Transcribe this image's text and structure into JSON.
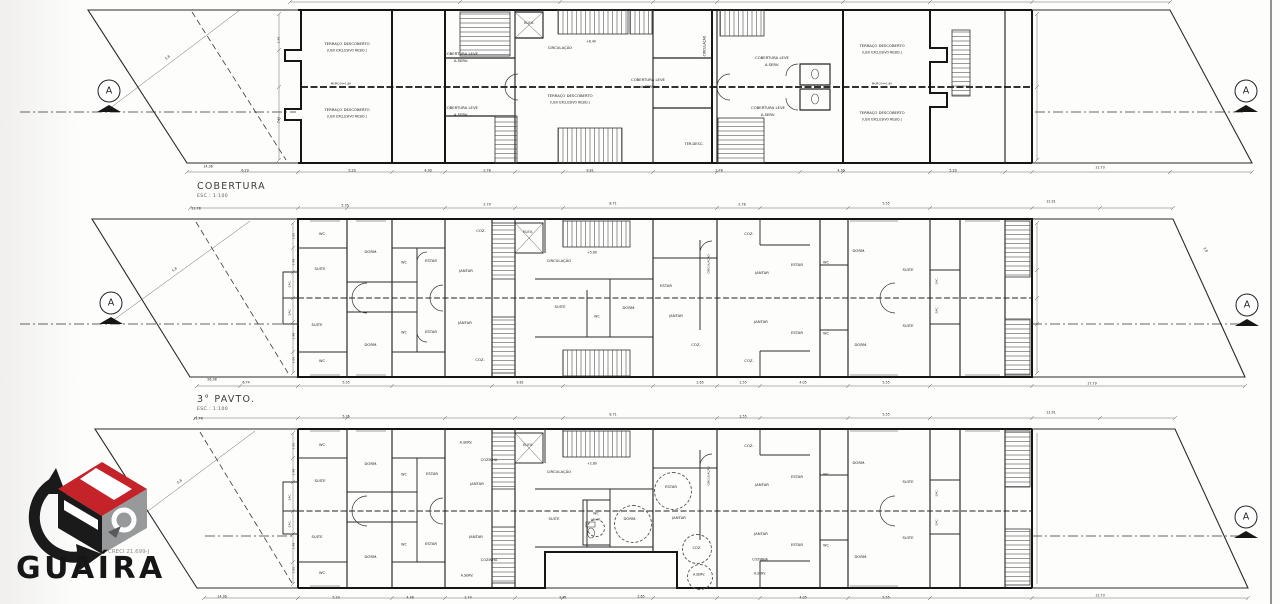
{
  "document": {
    "type": "architectural floor plans",
    "sheet_border_color": "#4a4a4a"
  },
  "section_marker_letter": "A",
  "logo": {
    "name": "GUAÍRA",
    "creci": "CRECI 21.699-J",
    "colors": {
      "red": "#c4232a",
      "gray": "#97999b",
      "black": "#1a1a1a"
    }
  },
  "plans": [
    {
      "title": "COBERTURA",
      "scale_note": "ESC.: 1:100",
      "texts": [
        {
          "t": "TERRAÇO DESCOBERTO",
          "x": 347,
          "y": 44
        },
        {
          "t": "(USO EXCLUSIVO RESID.)",
          "x": 347,
          "y": 51,
          "fs": 3.2
        },
        {
          "t": "TERRAÇO DESCOBERTO",
          "x": 347,
          "y": 110
        },
        {
          "t": "(USO EXCLUSIVO RESID.)",
          "x": 347,
          "y": 117,
          "fs": 3.2
        },
        {
          "t": "COBERTURA LEVE",
          "x": 461,
          "y": 54
        },
        {
          "t": "A.SERV.",
          "x": 461,
          "y": 61
        },
        {
          "t": "COBERTURA LEVE",
          "x": 461,
          "y": 108
        },
        {
          "t": "A.SERV.",
          "x": 461,
          "y": 115
        },
        {
          "t": "ELEV.",
          "x": 529,
          "y": 24,
          "fs": 3.6
        },
        {
          "t": "CIRCULAÇÃO",
          "x": 560,
          "y": 48
        },
        {
          "t": "+8.40",
          "x": 591,
          "y": 42,
          "fs": 3.2
        },
        {
          "t": "TERRAÇO DESCOBERTO",
          "x": 570,
          "y": 96
        },
        {
          "t": "(USO EXCLUSIVO RESID.)",
          "x": 570,
          "y": 103,
          "fs": 3.2
        },
        {
          "t": "COBERTURA LEVE",
          "x": 648,
          "y": 80
        },
        {
          "t": "A.SERV.",
          "x": 648,
          "y": 87
        },
        {
          "t": "TER.DESC.",
          "x": 694,
          "y": 145,
          "fs": 3.6
        },
        {
          "t": "CIRCULAÇÃO",
          "x": 705,
          "y": 46,
          "fs": 3.2,
          "r": -90
        },
        {
          "t": "COBERTURA LEVE",
          "x": 772,
          "y": 58
        },
        {
          "t": "A.SERV.",
          "x": 772,
          "y": 65
        },
        {
          "t": "COBERTURA LEVE",
          "x": 768,
          "y": 108
        },
        {
          "t": "A.SERV.",
          "x": 768,
          "y": 115
        },
        {
          "t": "TERRAÇO DESCOBERTO",
          "x": 882,
          "y": 46
        },
        {
          "t": "(USO EXCLUSIVO RESID.)",
          "x": 882,
          "y": 53,
          "fs": 3.2
        },
        {
          "t": "TERRAÇO DESCOBERTO",
          "x": 882,
          "y": 113
        },
        {
          "t": "(USO EXCLUSIVO RESID.)",
          "x": 882,
          "y": 120,
          "fs": 3.2
        },
        {
          "t": "MURO H=1.80",
          "x": 341,
          "y": 84,
          "fs": 2.8
        },
        {
          "t": "MURO H=1.80",
          "x": 882,
          "y": 84,
          "fs": 2.8
        },
        {
          "t": "14.36",
          "x": 208,
          "y": 167,
          "fs": 3.3
        },
        {
          "t": "6.29",
          "x": 245,
          "y": 171,
          "fs": 3.3
        },
        {
          "t": "5.20",
          "x": 352,
          "y": 171,
          "fs": 3.3
        },
        {
          "t": "4.30",
          "x": 428,
          "y": 171,
          "fs": 3.3
        },
        {
          "t": "2.78",
          "x": 487,
          "y": 171,
          "fs": 3.3
        },
        {
          "t": "9.81",
          "x": 590,
          "y": 171,
          "fs": 3.3
        },
        {
          "t": "2.78",
          "x": 719,
          "y": 171,
          "fs": 3.3
        },
        {
          "t": "4.30",
          "x": 841,
          "y": 171,
          "fs": 3.3
        },
        {
          "t": "5.20",
          "x": 953,
          "y": 171,
          "fs": 3.3
        },
        {
          "t": "11.73",
          "x": 1100,
          "y": 168,
          "fs": 3.3
        },
        {
          "t": "5.8",
          "x": 168,
          "y": 58,
          "fs": 3.3,
          "r": -37
        },
        {
          "t": "2.40",
          "x": 279,
          "y": 40,
          "fs": 3,
          "r": -90
        },
        {
          "t": "1.48",
          "x": 279,
          "y": 120,
          "fs": 3,
          "r": -90
        }
      ],
      "circles": []
    },
    {
      "title": "3° PAVTO.",
      "scale_note": "ESC.: 1:100",
      "texts": [
        {
          "t": "WC",
          "x": 322,
          "y": 235,
          "fs": 3.6
        },
        {
          "t": "SUITE",
          "x": 320,
          "y": 269
        },
        {
          "t": "DORM.",
          "x": 371,
          "y": 252
        },
        {
          "t": "WC",
          "x": 404,
          "y": 263,
          "fs": 3.4
        },
        {
          "t": "ESTAR",
          "x": 431,
          "y": 261
        },
        {
          "t": "JANTAR",
          "x": 466,
          "y": 271
        },
        {
          "t": "COZ.",
          "x": 481,
          "y": 231
        },
        {
          "t": "SAC.",
          "x": 290,
          "y": 284,
          "fs": 3,
          "r": -90
        },
        {
          "t": "SAC.",
          "x": 290,
          "y": 312,
          "fs": 3,
          "r": -90
        },
        {
          "t": "SUITE",
          "x": 317,
          "y": 325
        },
        {
          "t": "DORM.",
          "x": 371,
          "y": 345
        },
        {
          "t": "WC",
          "x": 322,
          "y": 362,
          "fs": 3.6
        },
        {
          "t": "WC",
          "x": 404,
          "y": 333,
          "fs": 3.4
        },
        {
          "t": "ESTAR",
          "x": 431,
          "y": 332
        },
        {
          "t": "JANTAR",
          "x": 465,
          "y": 323
        },
        {
          "t": "COZ.",
          "x": 480,
          "y": 360
        },
        {
          "t": "ELEV.",
          "x": 528,
          "y": 233,
          "fs": 3.6
        },
        {
          "t": "CIRCULAÇÃO",
          "x": 559,
          "y": 261
        },
        {
          "t": "+5.60",
          "x": 592,
          "y": 253,
          "fs": 3.2
        },
        {
          "t": "SUITE",
          "x": 560,
          "y": 307
        },
        {
          "t": "WC",
          "x": 597,
          "y": 317,
          "fs": 3.2
        },
        {
          "t": "DORM.",
          "x": 629,
          "y": 308
        },
        {
          "t": "ESTAR",
          "x": 666,
          "y": 286
        },
        {
          "t": "JANTAR",
          "x": 676,
          "y": 316
        },
        {
          "t": "COZ.",
          "x": 696,
          "y": 345
        },
        {
          "t": "CIRCULAÇÃO",
          "x": 709,
          "y": 264,
          "fs": 3,
          "r": -90
        },
        {
          "t": "COZ.",
          "x": 749,
          "y": 234
        },
        {
          "t": "JANTAR",
          "x": 762,
          "y": 273
        },
        {
          "t": "ESTAR",
          "x": 797,
          "y": 265
        },
        {
          "t": "WC",
          "x": 826,
          "y": 263,
          "fs": 3.4
        },
        {
          "t": "DORM.",
          "x": 859,
          "y": 251
        },
        {
          "t": "SUITE",
          "x": 908,
          "y": 270
        },
        {
          "t": "SAC.",
          "x": 937,
          "y": 281,
          "fs": 3,
          "r": -90
        },
        {
          "t": "SAC.",
          "x": 937,
          "y": 310,
          "fs": 3,
          "r": -90
        },
        {
          "t": "JANTAR",
          "x": 761,
          "y": 322
        },
        {
          "t": "ESTAR",
          "x": 797,
          "y": 333
        },
        {
          "t": "WC",
          "x": 826,
          "y": 334,
          "fs": 3.4
        },
        {
          "t": "DORM.",
          "x": 861,
          "y": 345
        },
        {
          "t": "SUITE",
          "x": 908,
          "y": 326
        },
        {
          "t": "COZ.",
          "x": 749,
          "y": 361
        },
        {
          "t": "11.78",
          "x": 196,
          "y": 209,
          "fs": 3.3
        },
        {
          "t": "5.35",
          "x": 345,
          "y": 206,
          "fs": 3.3
        },
        {
          "t": "2.79",
          "x": 487,
          "y": 205,
          "fs": 3.3
        },
        {
          "t": "8.71",
          "x": 613,
          "y": 204,
          "fs": 3.3
        },
        {
          "t": "2.78",
          "x": 742,
          "y": 205,
          "fs": 3.3
        },
        {
          "t": "5.55",
          "x": 886,
          "y": 204,
          "fs": 3.3
        },
        {
          "t": "12.91",
          "x": 1051,
          "y": 202,
          "fs": 3.3
        },
        {
          "t": "56.38",
          "x": 212,
          "y": 380,
          "fs": 3.3
        },
        {
          "t": "6.74",
          "x": 246,
          "y": 383,
          "fs": 3.3
        },
        {
          "t": "5.35",
          "x": 346,
          "y": 383,
          "fs": 3.3
        },
        {
          "t": "9.81",
          "x": 520,
          "y": 383,
          "fs": 3.3
        },
        {
          "t": "2.65",
          "x": 700,
          "y": 383,
          "fs": 3.3
        },
        {
          "t": "2.55",
          "x": 743,
          "y": 383,
          "fs": 3.3
        },
        {
          "t": "4.05",
          "x": 803,
          "y": 383,
          "fs": 3.3
        },
        {
          "t": "5.55",
          "x": 886,
          "y": 383,
          "fs": 3.3
        },
        {
          "t": "17.79",
          "x": 1092,
          "y": 384,
          "fs": 3.3
        },
        {
          "t": "5.8",
          "x": 175,
          "y": 270,
          "fs": 3.3,
          "r": -37
        },
        {
          "t": "3.8",
          "x": 1205,
          "y": 250,
          "fs": 3.3,
          "r": 60
        },
        {
          "t": "1.05",
          "x": 294,
          "y": 236,
          "fs": 3,
          "r": -90
        },
        {
          "t": "1.48",
          "x": 294,
          "y": 262,
          "fs": 3,
          "r": -90
        },
        {
          "t": "1.48",
          "x": 294,
          "y": 336,
          "fs": 3,
          "r": -90
        },
        {
          "t": "1.05",
          "x": 294,
          "y": 360,
          "fs": 3,
          "r": -90
        }
      ],
      "circles": []
    },
    {
      "title": "",
      "scale_note": "",
      "texts": [
        {
          "t": "WC",
          "x": 322,
          "y": 446,
          "fs": 3.6
        },
        {
          "t": "SUITE",
          "x": 320,
          "y": 481
        },
        {
          "t": "DORM.",
          "x": 371,
          "y": 464
        },
        {
          "t": "WC",
          "x": 404,
          "y": 475,
          "fs": 3.4
        },
        {
          "t": "ESTAR",
          "x": 432,
          "y": 474
        },
        {
          "t": "A.SERV.",
          "x": 466,
          "y": 443,
          "fs": 3.4
        },
        {
          "t": "COZINHA",
          "x": 489,
          "y": 461,
          "fs": 3.6
        },
        {
          "t": "JANTAR",
          "x": 477,
          "y": 484
        },
        {
          "t": "SAC.",
          "x": 290,
          "y": 497,
          "fs": 3,
          "r": -90
        },
        {
          "t": "SAC.",
          "x": 290,
          "y": 524,
          "fs": 3,
          "r": -90
        },
        {
          "t": "SUITE",
          "x": 317,
          "y": 537
        },
        {
          "t": "DORM.",
          "x": 371,
          "y": 557
        },
        {
          "t": "WC",
          "x": 322,
          "y": 574,
          "fs": 3.6
        },
        {
          "t": "WC",
          "x": 404,
          "y": 545,
          "fs": 3.4
        },
        {
          "t": "ESTAR",
          "x": 431,
          "y": 544
        },
        {
          "t": "JANTAR",
          "x": 476,
          "y": 537
        },
        {
          "t": "COZINHA",
          "x": 489,
          "y": 561,
          "fs": 3.6
        },
        {
          "t": "A.SERV.",
          "x": 467,
          "y": 576,
          "fs": 3.4
        },
        {
          "t": "ELEV.",
          "x": 528,
          "y": 446,
          "fs": 3.6
        },
        {
          "t": "CIRCULAÇÃO",
          "x": 559,
          "y": 472
        },
        {
          "t": "+2.80",
          "x": 592,
          "y": 464,
          "fs": 3.2
        },
        {
          "t": "SUITE",
          "x": 554,
          "y": 519
        },
        {
          "t": "WC",
          "x": 596,
          "y": 514,
          "fs": 3.2
        },
        {
          "t": "ADAPT.",
          "x": 596,
          "y": 520,
          "fs": 2.8
        },
        {
          "t": "DORM.",
          "x": 630,
          "y": 519
        },
        {
          "t": "ESTAR",
          "x": 671,
          "y": 487
        },
        {
          "t": "JANTAR",
          "x": 679,
          "y": 518
        },
        {
          "t": "COZ.",
          "x": 697,
          "y": 549,
          "fs": 3.6
        },
        {
          "t": "A.SERV.",
          "x": 699,
          "y": 575,
          "fs": 3.2
        },
        {
          "t": "CIRCULAÇÃO",
          "x": 709,
          "y": 476,
          "fs": 3,
          "r": -90
        },
        {
          "t": "COZ.",
          "x": 749,
          "y": 446
        },
        {
          "t": "JANTAR",
          "x": 762,
          "y": 485
        },
        {
          "t": "ESTAR",
          "x": 797,
          "y": 477
        },
        {
          "t": "WC",
          "x": 826,
          "y": 475,
          "fs": 3.4
        },
        {
          "t": "DORM.",
          "x": 859,
          "y": 463
        },
        {
          "t": "SUITE",
          "x": 908,
          "y": 482
        },
        {
          "t": "SAC.",
          "x": 937,
          "y": 493,
          "fs": 3,
          "r": -90
        },
        {
          "t": "SAC.",
          "x": 937,
          "y": 522,
          "fs": 3,
          "r": -90
        },
        {
          "t": "JANTAR",
          "x": 761,
          "y": 534
        },
        {
          "t": "ESTAR",
          "x": 797,
          "y": 545
        },
        {
          "t": "WC",
          "x": 826,
          "y": 546,
          "fs": 3.4
        },
        {
          "t": "DORM.",
          "x": 861,
          "y": 557
        },
        {
          "t": "SUITE",
          "x": 908,
          "y": 538
        },
        {
          "t": "COZINHA",
          "x": 760,
          "y": 560,
          "fs": 3.4
        },
        {
          "t": "A.SERV.",
          "x": 760,
          "y": 574,
          "fs": 3.2
        },
        {
          "t": "11.78",
          "x": 198,
          "y": 419,
          "fs": 3.3
        },
        {
          "t": "5.35",
          "x": 346,
          "y": 417,
          "fs": 3.3
        },
        {
          "t": "8.71",
          "x": 613,
          "y": 415,
          "fs": 3.3
        },
        {
          "t": "2.55",
          "x": 743,
          "y": 417,
          "fs": 3.3
        },
        {
          "t": "5.55",
          "x": 886,
          "y": 415,
          "fs": 3.3
        },
        {
          "t": "12.91",
          "x": 1051,
          "y": 413,
          "fs": 3.3
        },
        {
          "t": "14.36",
          "x": 222,
          "y": 597,
          "fs": 3.3
        },
        {
          "t": "5.20",
          "x": 336,
          "y": 598,
          "fs": 3.3
        },
        {
          "t": "4.38",
          "x": 410,
          "y": 598,
          "fs": 3.3
        },
        {
          "t": "2.74",
          "x": 468,
          "y": 598,
          "fs": 3.3
        },
        {
          "t": "9.81",
          "x": 563,
          "y": 598,
          "fs": 3.3
        },
        {
          "t": "2.65",
          "x": 641,
          "y": 597,
          "fs": 3.3
        },
        {
          "t": "4.05",
          "x": 803,
          "y": 598,
          "fs": 3.3
        },
        {
          "t": "5.55",
          "x": 886,
          "y": 598,
          "fs": 3.3
        },
        {
          "t": "11.73",
          "x": 1100,
          "y": 596,
          "fs": 3.3
        },
        {
          "t": "5.8",
          "x": 180,
          "y": 482,
          "fs": 3.3,
          "r": -37
        },
        {
          "t": "1.05",
          "x": 294,
          "y": 446,
          "fs": 3,
          "r": -90
        },
        {
          "t": "1.48",
          "x": 294,
          "y": 472,
          "fs": 3,
          "r": -90
        },
        {
          "t": "1.48",
          "x": 294,
          "y": 546,
          "fs": 3,
          "r": -90
        },
        {
          "t": "1.05",
          "x": 294,
          "y": 570,
          "fs": 3,
          "r": -90
        }
      ],
      "circles": [
        [
          673,
          491,
          19
        ],
        [
          633,
          524,
          19
        ],
        [
          596,
          528,
          9
        ],
        [
          697,
          549,
          15
        ],
        [
          700,
          577,
          13
        ]
      ]
    }
  ]
}
